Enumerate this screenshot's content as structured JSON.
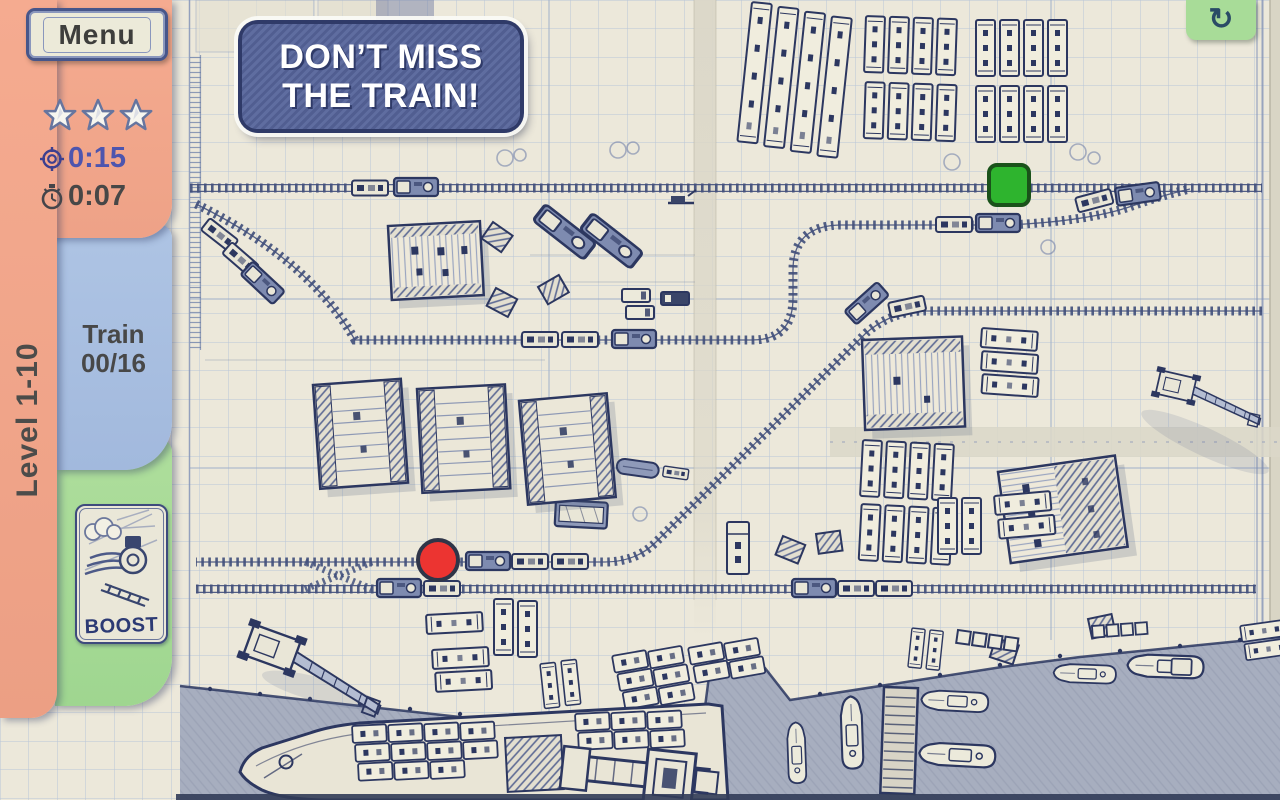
{
  "hud": {
    "menu_label": "Menu",
    "stars": 3,
    "target_time": "0:15",
    "elapsed_time": "0:07",
    "level_label": "Level 1-10",
    "train_tab_label": "Train",
    "train_tab_count": "00/16",
    "boost_label": "BOOST",
    "refresh_icon": "↻"
  },
  "banner": {
    "line1": "DON’T MISS",
    "line2": "THE TRAIN!"
  },
  "signals": {
    "go": {
      "shape": "square",
      "color": "#2eb42e",
      "border": "#1a521a"
    },
    "stop": {
      "shape": "circle",
      "color": "#ec3431",
      "border": "#2f3548"
    }
  },
  "colors": {
    "sidebar": "#f2a68c",
    "tab_train": "#a9c0e1",
    "tab_boost": "#a8dc98",
    "paper": "#ece8da",
    "grid": "#b9c6d8",
    "ink": "#2c3760",
    "time_target_text": "#4d55ae",
    "time_elapsed_text": "#474747",
    "banner_bg": "#5a6898",
    "banner_border": "#2f3a68",
    "banner_text": "#ffffff",
    "water": "#a7aebf"
  }
}
